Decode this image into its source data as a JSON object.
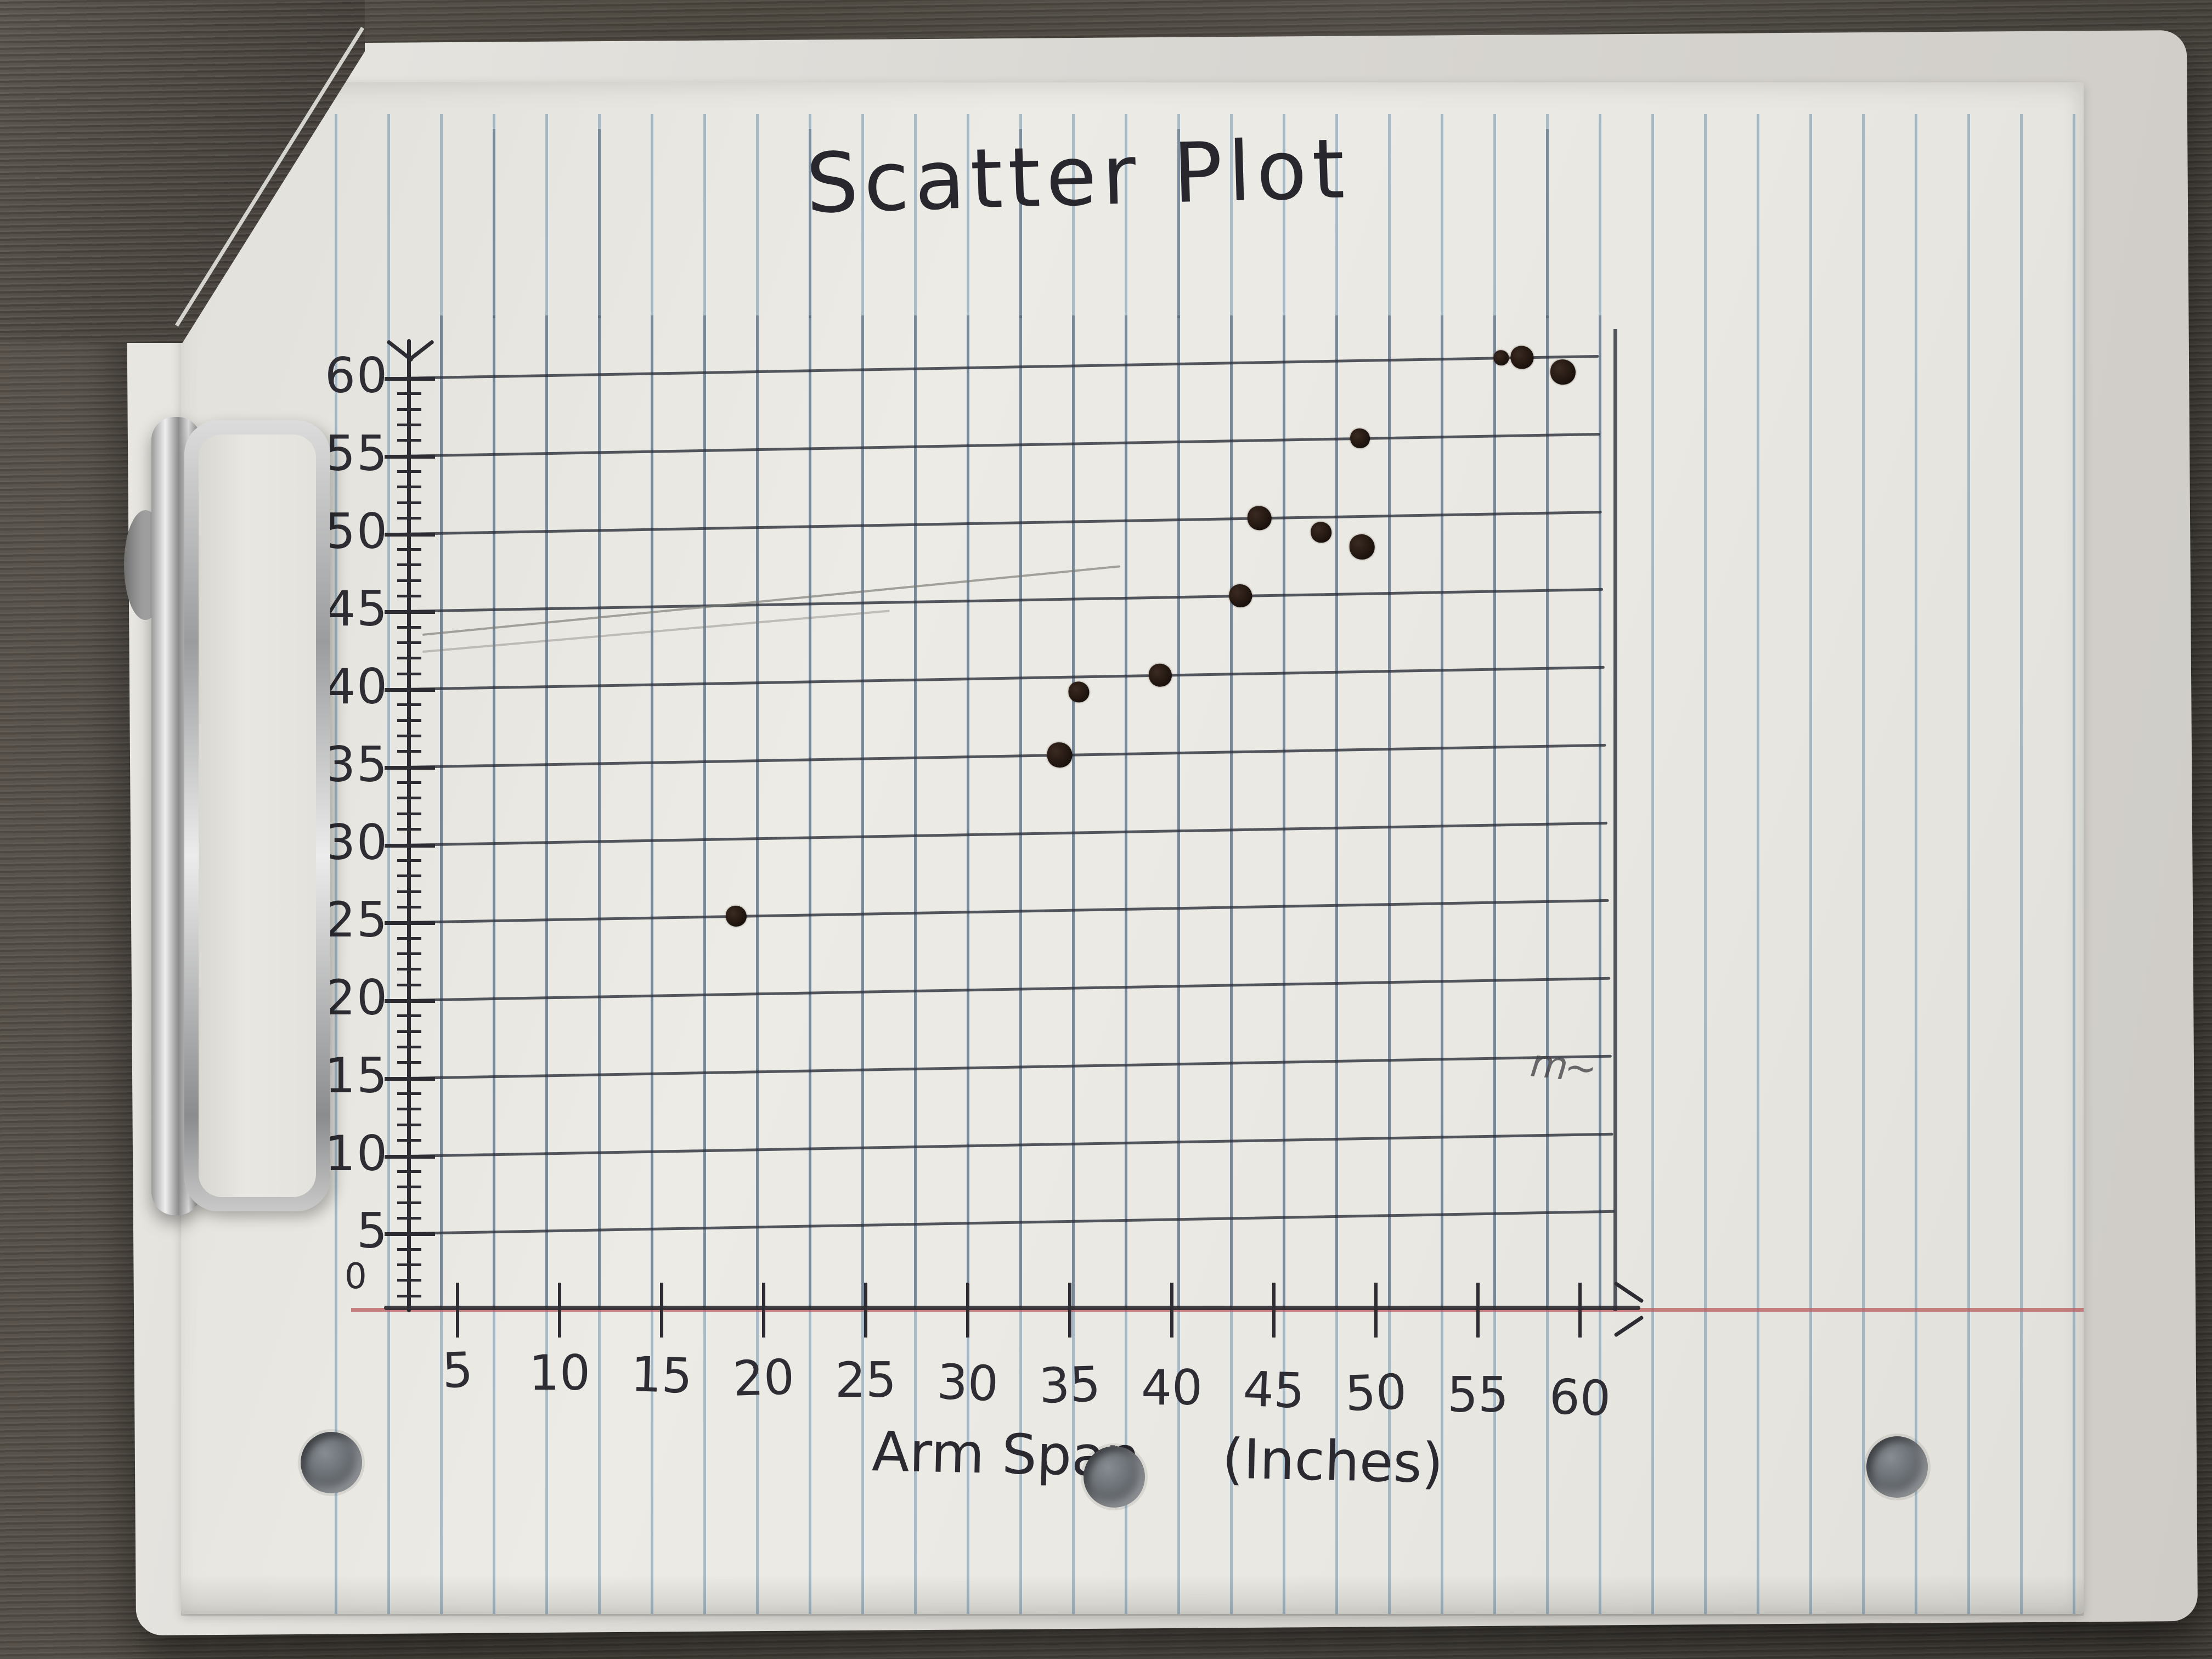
{
  "photo": {
    "scene": "hand-drawn scatter plot on blue-ruled notebook paper held on a clipboard over a dark wood desk",
    "title": "Scatter Plot",
    "x_axis_title_part1": "Arm Span",
    "x_axis_title_part2": "(Inches)",
    "y_axis_title": "Height (Inches)",
    "origin_label": "0"
  },
  "chart_data": {
    "type": "scatter",
    "title": "Scatter Plot",
    "xlabel": "Arm Span (Inches)",
    "ylabel": "Height (Inches)",
    "xlim": [
      0,
      60
    ],
    "ylim": [
      0,
      60
    ],
    "grid": true,
    "legend": false,
    "x_tick_labels": [
      "5",
      "10",
      "15",
      "20",
      "25",
      "30",
      "35",
      "40",
      "45",
      "50",
      "55",
      "60"
    ],
    "y_tick_labels": [
      "60",
      "55",
      "50",
      "45",
      "40",
      "35",
      "30",
      "25",
      "20",
      "15",
      "10",
      "5"
    ],
    "points": [
      {
        "arm_span": 19,
        "height": 25
      },
      {
        "arm_span": 35,
        "height": 35
      },
      {
        "arm_span": 36,
        "height": 39
      },
      {
        "arm_span": 40,
        "height": 40
      },
      {
        "arm_span": 44,
        "height": 45
      },
      {
        "arm_span": 45,
        "height": 50
      },
      {
        "arm_span": 48,
        "height": 49
      },
      {
        "arm_span": 50,
        "height": 48
      },
      {
        "arm_span": 50,
        "height": 55
      },
      {
        "arm_span": 57,
        "height": 60
      },
      {
        "arm_span": 58,
        "height": 60
      },
      {
        "arm_span": 60,
        "height": 59
      }
    ],
    "annotations": [
      "stray pencil streak rising from about (0,45) to (38,49)",
      "small pencil scribble near (56,15) on the 15 gridline"
    ]
  },
  "colors": {
    "paper": "#eae8e2",
    "ruled_line_blue": "#608caf",
    "margin_line_red": "#ba5c5c",
    "ink": "#2e2d33",
    "pencil_gray": "#8f8e8a",
    "desk_wood": "#4c473f",
    "clip_metal": "#c9c9c9",
    "dot_ink": "#1b110c"
  }
}
